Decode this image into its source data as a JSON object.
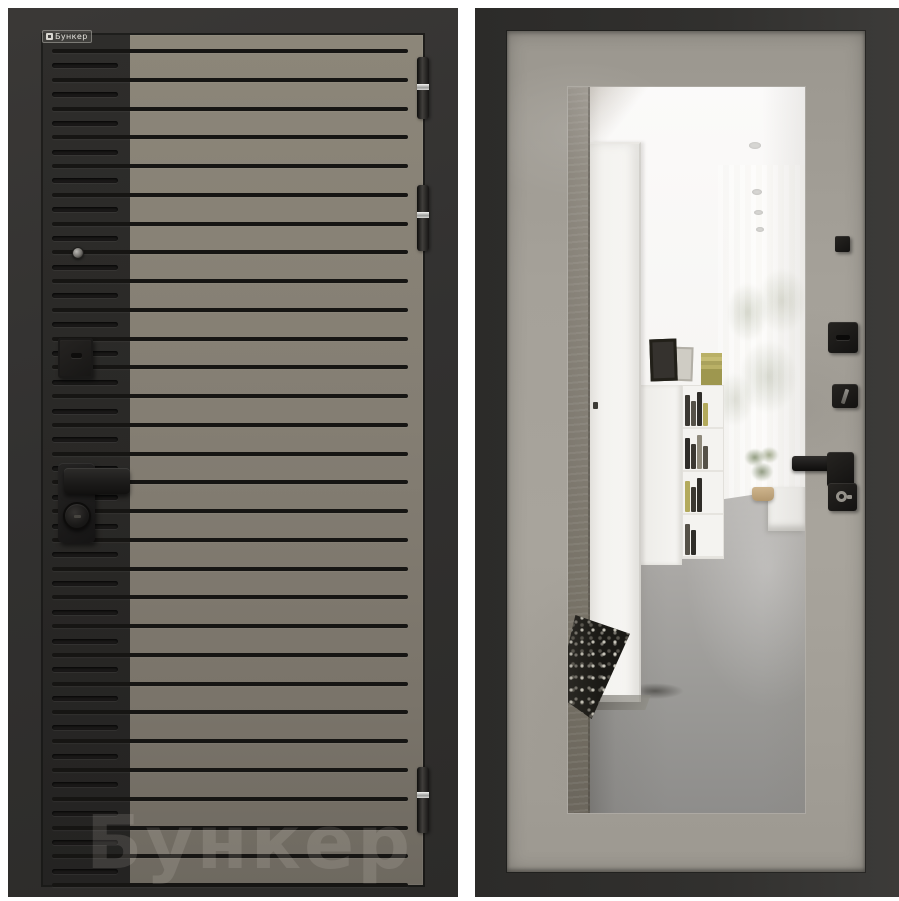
{
  "brand": {
    "label": "Бункер",
    "watermark": "Бункер"
  },
  "palette": {
    "background": "#ffffff",
    "frame_dark": "#31302e",
    "leaf_black": "#2b2a28",
    "leaf_taupe": "#837d72",
    "groove": "#161513",
    "concrete": "#a29e96",
    "hardware_black": "#1b1a18",
    "chrome": "#d9d9d7"
  },
  "left_door": {
    "description": "exterior side, black frame, taupe ribbed face with black left band",
    "grooves": {
      "full_count": 30,
      "first_top": 14,
      "spacing": 28.76,
      "short_count": 29,
      "short_first_top": 28.4
    },
    "hinges": [
      {
        "top": 49,
        "height": 62,
        "band": 27
      },
      {
        "top": 177,
        "height": 66,
        "band": 27
      },
      {
        "top": 759,
        "height": 66,
        "band": 25
      }
    ],
    "hardware": [
      "peephole",
      "lock-escutcheon",
      "handle-lever",
      "cylinder-knob"
    ]
  },
  "right_door": {
    "description": "interior side, concrete-look face with full-length mirror",
    "hardware": [
      "peephole-cover",
      "deadbolt-thumbturn",
      "wc-thumbturn",
      "handle-lever",
      "key-cylinder"
    ],
    "mirror_reflection": {
      "elements": [
        "hallway",
        "white-interior-door",
        "bookshelf",
        "picture-frames",
        "window-light",
        "foliage",
        "plant",
        "polished-concrete-floor",
        "pebble-mat",
        "ceiling-lights"
      ],
      "ceiling_lights": [
        {
          "x": 181,
          "y": 55,
          "w": 12,
          "h": 7
        },
        {
          "x": 184,
          "y": 102,
          "w": 10,
          "h": 6
        },
        {
          "x": 186,
          "y": 123,
          "w": 9,
          "h": 5
        },
        {
          "x": 188,
          "y": 140,
          "w": 8,
          "h": 5
        }
      ],
      "shelf_rows": [
        [
          "#3b3832",
          "#565249",
          "#2f2d29",
          "#b3aa5c"
        ],
        [
          "#2f2d29",
          "#3b3832",
          "#8e897b",
          "#565249"
        ],
        [
          "#b3aa5c",
          "#3b3832",
          "#2f2d29"
        ],
        [
          "#565249",
          "#2f2d29"
        ]
      ]
    }
  }
}
